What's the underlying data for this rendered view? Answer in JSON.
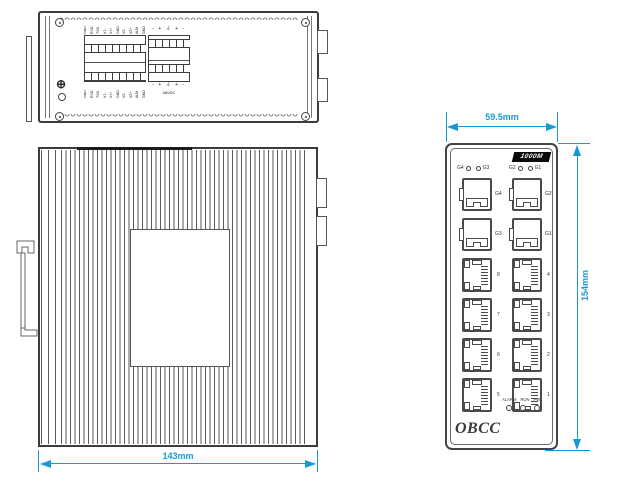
{
  "colors": {
    "dimension": "#1899d4",
    "line": "#4a4a4a",
    "badge_bg": "#0b0b0b"
  },
  "top_view": {
    "ground_symbol": "⊕",
    "left_terminal": {
      "top_labels": [
        "GND",
        "RXD",
        "TXD",
        "V1-",
        "V1+",
        "GND",
        "V2-",
        "V2+",
        "ALM",
        "GND"
      ],
      "bottom_labels": [
        "GND",
        "RXD",
        "TXD",
        "V1-",
        "V1+",
        "GND",
        "V2-",
        "V2+",
        "ALM",
        "GND"
      ]
    },
    "power_terminal": {
      "top_marks": "- + ⏚ + -",
      "bottom_marks": "- + ⏚ + -",
      "caption": "48VDC"
    }
  },
  "rear_view": {
    "width_dim": "143mm"
  },
  "front_panel": {
    "width_dim": "59.5mm",
    "height_dim": "154mm",
    "badge": "1000M",
    "led_groups": [
      {
        "left": "G4",
        "right": "G3"
      },
      {
        "left": "G2",
        "right": "G1"
      }
    ],
    "sfp_rows": [
      {
        "left": "G4",
        "right": "G2"
      },
      {
        "left": "G3",
        "right": "G1"
      }
    ],
    "rj45_rows": [
      {
        "left": "8",
        "right": "4"
      },
      {
        "left": "7",
        "right": "3"
      },
      {
        "left": "6",
        "right": "2"
      },
      {
        "left": "5",
        "right": "1"
      }
    ],
    "status_leds": [
      "ALARM",
      "RUN",
      "PW"
    ],
    "logo": "OBCC"
  }
}
